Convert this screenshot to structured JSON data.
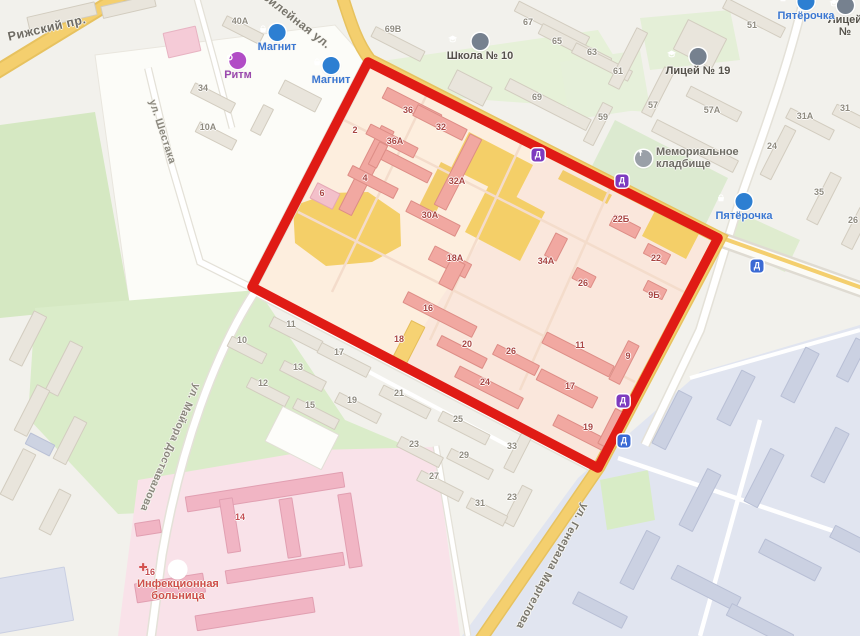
{
  "map": {
    "type": "city-map-with-highlighted-block",
    "palette": {
      "background": "#f2f1ec",
      "highlight_outline": "#e01b15",
      "road_yellow": "#f4cf6e",
      "residential_building": "#f1a8a1",
      "yellow_zone": "#f4cf68",
      "park_green": "#d9ecc8",
      "industrial_zone": "#e1e5f0",
      "hospital_zone": "#f9e2e9",
      "poi_blue": "#2d7fd2",
      "poi_purple": "#b14cc6",
      "transit_purple": "#7d3bbf",
      "transit_blue": "#3b6ad4"
    }
  },
  "streets": [
    {
      "id": "rizhsky",
      "label": "Рижский пр.",
      "x": 8,
      "y": 30,
      "r": -13,
      "size": 12.5,
      "color": "#6f6c64"
    },
    {
      "id": "yubileynaya",
      "label": "Юбилейная ул.",
      "x": 254,
      "y": -20,
      "r": 38,
      "size": 12,
      "color": "#79766d"
    },
    {
      "id": "shestaka",
      "label": "ул. Шестака",
      "x": 152,
      "y": 94,
      "r": 72,
      "size": 10.5,
      "color": "#8a877d"
    },
    {
      "id": "dostavalova",
      "label": "ул. Майора Доставалова",
      "x": 197,
      "y": 378,
      "r": 113,
      "size": 10.5,
      "color": "#8a877d"
    },
    {
      "id": "margelova",
      "label": "ул. Генерала Маргелова",
      "x": 585,
      "y": 498,
      "r": 118,
      "size": 11,
      "color": "#79766d"
    }
  ],
  "pois": [
    {
      "id": "magnit-1",
      "label": "Магнит",
      "icon": "basket",
      "color": "#2d7fd2",
      "label_color": "#3c78d2",
      "x": 277,
      "y": 33
    },
    {
      "id": "magnit-2",
      "label": "Магнит",
      "icon": "basket",
      "color": "#2d7fd2",
      "label_color": "#3c78d2",
      "x": 331,
      "y": 66
    },
    {
      "id": "ritm",
      "label": "Ритм",
      "icon": "flower",
      "color": "#b14cc6",
      "label_color": "#9a49ad",
      "x": 238,
      "y": 61
    },
    {
      "id": "school-10",
      "label": "Школа № 10",
      "icon": "school",
      "color": "#76818f",
      "label_color": "#55524b",
      "x": 480,
      "y": 42
    },
    {
      "id": "licey-19",
      "label": "Лицей № 19",
      "icon": "school",
      "color": "#76818f",
      "label_color": "#55524b",
      "x": 698,
      "y": 57
    },
    {
      "id": "licey-edge",
      "label": "Лицей №",
      "icon": "school",
      "color": "#76818f",
      "label_color": "#55524b",
      "x": 845,
      "y": 6
    },
    {
      "id": "pyaterochka-1",
      "label": "Пятёрочка",
      "icon": "basket",
      "color": "#2d7fd2",
      "label_color": "#3c78d2",
      "x": 806,
      "y": 2
    },
    {
      "id": "pyaterochka-2",
      "label": "Пятёрочка",
      "icon": "basket",
      "color": "#2d7fd2",
      "label_color": "#3c78d2",
      "x": 744,
      "y": 202
    },
    {
      "id": "memorial-cemetery",
      "label": "Мемориальное\nкладбище",
      "icon": "memorial",
      "color": "#9aa0a8",
      "label_color": "#6f6d65",
      "x": 635,
      "y": 156,
      "side": true
    },
    {
      "id": "infection-hospital",
      "label": "Инфекционная\nбольница",
      "icon": "cross",
      "color": "#ffffff",
      "label_color": "#cf4f4a",
      "x": 178,
      "y": 570
    }
  ],
  "transit_markers": [
    {
      "glyph": "Д",
      "color": "#7d3bbf",
      "x": 538,
      "y": 155
    },
    {
      "glyph": "Д",
      "color": "#7d3bbf",
      "x": 622,
      "y": 181
    },
    {
      "glyph": "Д",
      "color": "#7d3bbf",
      "x": 623,
      "y": 401
    },
    {
      "glyph": "Д",
      "color": "#3b6ad4",
      "x": 757,
      "y": 266
    },
    {
      "glyph": "Д",
      "color": "#3b6ad4",
      "x": 624,
      "y": 441
    }
  ],
  "buildings": [
    {
      "name": "inner-block",
      "fill": "#f1a8a1",
      "stroke": "#dd8d86",
      "label_color": "#a84542",
      "items": [
        {
          "x": 366,
          "y": 170,
          "w": 95,
          "h": 15,
          "r": 117,
          "n": "2",
          "lx": 355,
          "ly": 130
        },
        {
          "x": 412,
          "y": 106,
          "w": 62,
          "h": 13,
          "r": 27,
          "n": "36",
          "lx": 408,
          "ly": 110
        },
        {
          "x": 392,
          "y": 141,
          "w": 54,
          "h": 12,
          "r": 27,
          "n": "36А",
          "lx": 395,
          "ly": 141
        },
        {
          "x": 406,
          "y": 166,
          "w": 54,
          "h": 12,
          "r": 27
        },
        {
          "x": 378,
          "y": 155,
          "w": 26,
          "h": 10,
          "r": 117
        },
        {
          "x": 440,
          "y": 122,
          "w": 56,
          "h": 13,
          "r": 27,
          "n": "32",
          "lx": 441,
          "ly": 127
        },
        {
          "x": 373,
          "y": 182,
          "w": 52,
          "h": 12,
          "r": 27,
          "n": "4",
          "lx": 365,
          "ly": 178
        },
        {
          "x": 458,
          "y": 172,
          "w": 80,
          "h": 14,
          "r": 117,
          "n": "32А",
          "lx": 457,
          "ly": 181
        },
        {
          "x": 433,
          "y": 218,
          "w": 56,
          "h": 13,
          "r": 27,
          "n": "30А",
          "lx": 430,
          "ly": 215
        },
        {
          "x": 325,
          "y": 196,
          "w": 26,
          "h": 18,
          "r": 27,
          "n": "6",
          "lx": 322,
          "ly": 193,
          "f": "#f3c0ca",
          "s": "#e5a7b4"
        },
        {
          "x": 450,
          "y": 262,
          "w": 42,
          "h": 16,
          "r": 27,
          "n": "18А",
          "lx": 455,
          "ly": 258
        },
        {
          "x": 452,
          "y": 274,
          "w": 16,
          "h": 30,
          "r": 27
        },
        {
          "x": 556,
          "y": 247,
          "w": 26,
          "h": 14,
          "r": 117,
          "n": "34А",
          "lx": 546,
          "ly": 261
        },
        {
          "x": 584,
          "y": 277,
          "w": 22,
          "h": 13,
          "r": 27,
          "n": "26",
          "lx": 583,
          "ly": 283
        },
        {
          "x": 625,
          "y": 226,
          "w": 30,
          "h": 13,
          "r": 27,
          "n": "22Б",
          "lx": 621,
          "ly": 219
        },
        {
          "x": 657,
          "y": 254,
          "w": 26,
          "h": 12,
          "r": 27,
          "n": "22",
          "lx": 656,
          "ly": 258
        },
        {
          "x": 655,
          "y": 290,
          "w": 22,
          "h": 12,
          "r": 27,
          "n": "9Б",
          "lx": 654,
          "ly": 295
        },
        {
          "x": 440,
          "y": 314,
          "w": 78,
          "h": 13,
          "r": 27,
          "n": "16",
          "lx": 428,
          "ly": 308
        },
        {
          "x": 408,
          "y": 344,
          "w": 46,
          "h": 16,
          "r": 117,
          "n": "18",
          "lx": 399,
          "ly": 339,
          "f": "#f6d273",
          "s": "#e5bd59"
        },
        {
          "x": 462,
          "y": 352,
          "w": 52,
          "h": 12,
          "r": 27,
          "n": "20",
          "lx": 467,
          "ly": 344
        },
        {
          "x": 516,
          "y": 360,
          "w": 48,
          "h": 12,
          "r": 27,
          "n": "26",
          "lx": 511,
          "ly": 351
        },
        {
          "x": 489,
          "y": 387,
          "w": 72,
          "h": 13,
          "r": 27,
          "n": "24",
          "lx": 485,
          "ly": 382
        },
        {
          "x": 578,
          "y": 354,
          "w": 76,
          "h": 13,
          "r": 27,
          "n": "11",
          "lx": 580,
          "ly": 345
        },
        {
          "x": 567,
          "y": 388,
          "w": 64,
          "h": 13,
          "r": 27,
          "n": "17",
          "lx": 570,
          "ly": 386
        },
        {
          "x": 580,
          "y": 432,
          "w": 56,
          "h": 13,
          "r": 27,
          "n": "19",
          "lx": 588,
          "ly": 427
        },
        {
          "x": 624,
          "y": 362,
          "w": 44,
          "h": 13,
          "r": 117,
          "n": "9",
          "lx": 628,
          "ly": 356
        },
        {
          "x": 612,
          "y": 428,
          "w": 40,
          "h": 13,
          "r": 117
        }
      ]
    },
    {
      "name": "outer-block",
      "fill": "#e9e5dc",
      "stroke": "#d2ccbf",
      "label_color": "#8e8a7f",
      "items": [
        {
          "x": 62,
          "y": 16,
          "w": 70,
          "h": 14,
          "r": -13
        },
        {
          "x": 128,
          "y": 6,
          "w": 55,
          "h": 13,
          "r": -13
        },
        {
          "x": 182,
          "y": 42,
          "w": 34,
          "h": 26,
          "r": -13,
          "f": "#f5cbd7",
          "s": "#e7b3c2"
        },
        {
          "x": 243,
          "y": 30,
          "w": 42,
          "h": 12,
          "r": 27,
          "n": "40А",
          "lx": 240,
          "ly": 21
        },
        {
          "x": 213,
          "y": 98,
          "w": 46,
          "h": 12,
          "r": 27,
          "n": "34",
          "lx": 203,
          "ly": 88
        },
        {
          "x": 216,
          "y": 136,
          "w": 42,
          "h": 12,
          "r": 27,
          "n": "10А",
          "lx": 208,
          "ly": 127
        },
        {
          "x": 262,
          "y": 120,
          "w": 30,
          "h": 12,
          "r": 117
        },
        {
          "x": 300,
          "y": 96,
          "w": 42,
          "h": 16,
          "r": 27
        },
        {
          "x": 398,
          "y": 44,
          "w": 56,
          "h": 12,
          "r": 27,
          "n": "69В",
          "lx": 393,
          "ly": 29
        },
        {
          "x": 470,
          "y": 88,
          "w": 40,
          "h": 22,
          "r": 27
        },
        {
          "x": 552,
          "y": 24,
          "w": 80,
          "h": 12,
          "r": 27,
          "n": "67",
          "lx": 528,
          "ly": 22
        },
        {
          "x": 575,
          "y": 46,
          "w": 78,
          "h": 12,
          "r": 27,
          "n": "65",
          "lx": 557,
          "ly": 41
        },
        {
          "x": 602,
          "y": 62,
          "w": 64,
          "h": 12,
          "r": 27,
          "n": "63",
          "lx": 592,
          "ly": 52
        },
        {
          "x": 548,
          "y": 104,
          "w": 92,
          "h": 13,
          "r": 27,
          "n": "69",
          "lx": 537,
          "ly": 97
        },
        {
          "x": 628,
          "y": 58,
          "w": 64,
          "h": 13,
          "r": 117,
          "n": "61",
          "lx": 618,
          "ly": 71
        },
        {
          "x": 658,
          "y": 92,
          "w": 52,
          "h": 12,
          "r": 117,
          "n": "57",
          "lx": 653,
          "ly": 105
        },
        {
          "x": 598,
          "y": 124,
          "w": 44,
          "h": 12,
          "r": 117,
          "n": "59",
          "lx": 603,
          "ly": 117
        },
        {
          "x": 714,
          "y": 104,
          "w": 58,
          "h": 12,
          "r": 27,
          "n": "57А",
          "lx": 712,
          "ly": 110
        },
        {
          "x": 754,
          "y": 18,
          "w": 66,
          "h": 12,
          "r": 27,
          "n": "51",
          "lx": 752,
          "ly": 25
        },
        {
          "x": 700,
          "y": 44,
          "w": 44,
          "h": 34,
          "r": 27
        },
        {
          "x": 810,
          "y": 124,
          "w": 50,
          "h": 12,
          "r": 27,
          "n": "31А",
          "lx": 805,
          "ly": 116
        },
        {
          "x": 852,
          "y": 118,
          "w": 40,
          "h": 12,
          "r": 27,
          "n": "31",
          "lx": 845,
          "ly": 108
        },
        {
          "x": 695,
          "y": 146,
          "w": 92,
          "h": 14,
          "r": 27
        },
        {
          "x": 778,
          "y": 152,
          "w": 56,
          "h": 13,
          "r": 117,
          "n": "24",
          "lx": 772,
          "ly": 146
        },
        {
          "x": 824,
          "y": 198,
          "w": 54,
          "h": 13,
          "r": 117,
          "n": "35",
          "lx": 819,
          "ly": 192
        },
        {
          "x": 856,
          "y": 228,
          "w": 42,
          "h": 13,
          "r": 117,
          "n": "26",
          "lx": 853,
          "ly": 220
        },
        {
          "x": 296,
          "y": 334,
          "w": 56,
          "h": 12,
          "r": 27,
          "n": "11",
          "lx": 291,
          "ly": 324
        },
        {
          "x": 247,
          "y": 350,
          "w": 40,
          "h": 12,
          "r": 27,
          "n": "10",
          "lx": 242,
          "ly": 340
        },
        {
          "x": 344,
          "y": 360,
          "w": 56,
          "h": 12,
          "r": 27,
          "n": "17",
          "lx": 339,
          "ly": 352
        },
        {
          "x": 303,
          "y": 376,
          "w": 48,
          "h": 12,
          "r": 27,
          "n": "13",
          "lx": 298,
          "ly": 367
        },
        {
          "x": 268,
          "y": 392,
          "w": 44,
          "h": 12,
          "r": 27,
          "n": "12",
          "lx": 263,
          "ly": 383
        },
        {
          "x": 316,
          "y": 414,
          "w": 48,
          "h": 12,
          "r": 27,
          "n": "15",
          "lx": 310,
          "ly": 405
        },
        {
          "x": 358,
          "y": 408,
          "w": 48,
          "h": 12,
          "r": 27,
          "n": "19",
          "lx": 352,
          "ly": 400
        },
        {
          "x": 405,
          "y": 402,
          "w": 54,
          "h": 12,
          "r": 27,
          "n": "21",
          "lx": 399,
          "ly": 393
        },
        {
          "x": 464,
          "y": 428,
          "w": 54,
          "h": 12,
          "r": 27,
          "n": "25",
          "lx": 458,
          "ly": 419
        },
        {
          "x": 420,
          "y": 452,
          "w": 48,
          "h": 12,
          "r": 27,
          "n": "23",
          "lx": 414,
          "ly": 444
        },
        {
          "x": 470,
          "y": 464,
          "w": 48,
          "h": 12,
          "r": 27,
          "n": "29",
          "lx": 464,
          "ly": 455
        },
        {
          "x": 440,
          "y": 486,
          "w": 48,
          "h": 12,
          "r": 27,
          "n": "27",
          "lx": 434,
          "ly": 476
        },
        {
          "x": 518,
          "y": 452,
          "w": 42,
          "h": 12,
          "r": 117,
          "n": "33",
          "lx": 512,
          "ly": 446
        },
        {
          "x": 518,
          "y": 506,
          "w": 42,
          "h": 12,
          "r": 117,
          "n": "23",
          "lx": 512,
          "ly": 497
        },
        {
          "x": 487,
          "y": 512,
          "w": 42,
          "h": 12,
          "r": 27,
          "n": "31",
          "lx": 480,
          "ly": 503
        },
        {
          "x": 302,
          "y": 438,
          "w": 64,
          "h": 40,
          "r": 27,
          "f": "#fdfdfa",
          "s": "#e2dfd6"
        },
        {
          "x": 28,
          "y": 338,
          "w": 56,
          "h": 15,
          "r": 117
        },
        {
          "x": 64,
          "y": 368,
          "w": 56,
          "h": 15,
          "r": 117
        },
        {
          "x": 32,
          "y": 410,
          "w": 52,
          "h": 15,
          "r": 117
        },
        {
          "x": 70,
          "y": 440,
          "w": 48,
          "h": 15,
          "r": 117
        },
        {
          "x": 18,
          "y": 474,
          "w": 52,
          "h": 15,
          "r": 117
        },
        {
          "x": 40,
          "y": 444,
          "w": 28,
          "h": 13,
          "r": 27,
          "f": "#cdd3e2",
          "s": "#bac1d6"
        },
        {
          "x": 55,
          "y": 512,
          "w": 46,
          "h": 14,
          "r": 117
        },
        {
          "x": 30,
          "y": 600,
          "w": 80,
          "h": 55,
          "r": -10,
          "f": "#dce0ed",
          "s": "#c9cfe2"
        }
      ]
    },
    {
      "name": "hospital",
      "fill": "#f1b5c4",
      "stroke": "#e19fb1",
      "label_color": "#c44f54",
      "items": [
        {
          "x": 265,
          "y": 492,
          "w": 160,
          "h": 16,
          "r": -9,
          "n": "14",
          "lx": 240,
          "ly": 517
        },
        {
          "x": 230,
          "y": 525,
          "w": 14,
          "h": 55,
          "r": -9
        },
        {
          "x": 290,
          "y": 528,
          "w": 14,
          "h": 60,
          "r": -9
        },
        {
          "x": 350,
          "y": 530,
          "w": 14,
          "h": 75,
          "r": -9
        },
        {
          "x": 285,
          "y": 568,
          "w": 120,
          "h": 14,
          "r": -9
        },
        {
          "x": 170,
          "y": 588,
          "w": 70,
          "h": 20,
          "r": -9,
          "n": "16",
          "lx": 150,
          "ly": 572
        },
        {
          "x": 255,
          "y": 614,
          "w": 120,
          "h": 16,
          "r": -9
        },
        {
          "x": 148,
          "y": 528,
          "w": 26,
          "h": 14,
          "r": -9
        }
      ]
    },
    {
      "name": "industrial",
      "fill": "#cbd1e2",
      "stroke": "#b8bfd5",
      "label_color": "#8b90a5",
      "items": [
        {
          "x": 672,
          "y": 420,
          "w": 60,
          "h": 16,
          "r": 117
        },
        {
          "x": 736,
          "y": 398,
          "w": 56,
          "h": 16,
          "r": 117
        },
        {
          "x": 800,
          "y": 375,
          "w": 56,
          "h": 16,
          "r": 117
        },
        {
          "x": 852,
          "y": 360,
          "w": 44,
          "h": 14,
          "r": 117
        },
        {
          "x": 700,
          "y": 500,
          "w": 64,
          "h": 16,
          "r": 117
        },
        {
          "x": 764,
          "y": 478,
          "w": 60,
          "h": 16,
          "r": 117
        },
        {
          "x": 830,
          "y": 455,
          "w": 56,
          "h": 16,
          "r": 117
        },
        {
          "x": 640,
          "y": 560,
          "w": 60,
          "h": 16,
          "r": 117
        },
        {
          "x": 706,
          "y": 588,
          "w": 72,
          "h": 16,
          "r": 27
        },
        {
          "x": 790,
          "y": 560,
          "w": 64,
          "h": 16,
          "r": 27
        },
        {
          "x": 850,
          "y": 540,
          "w": 40,
          "h": 14,
          "r": 27
        },
        {
          "x": 600,
          "y": 610,
          "w": 56,
          "h": 14,
          "r": 27
        },
        {
          "x": 760,
          "y": 625,
          "w": 70,
          "h": 14,
          "r": 27
        }
      ]
    }
  ],
  "highlight_polygon": "368,62 718,238 598,468 252,287"
}
